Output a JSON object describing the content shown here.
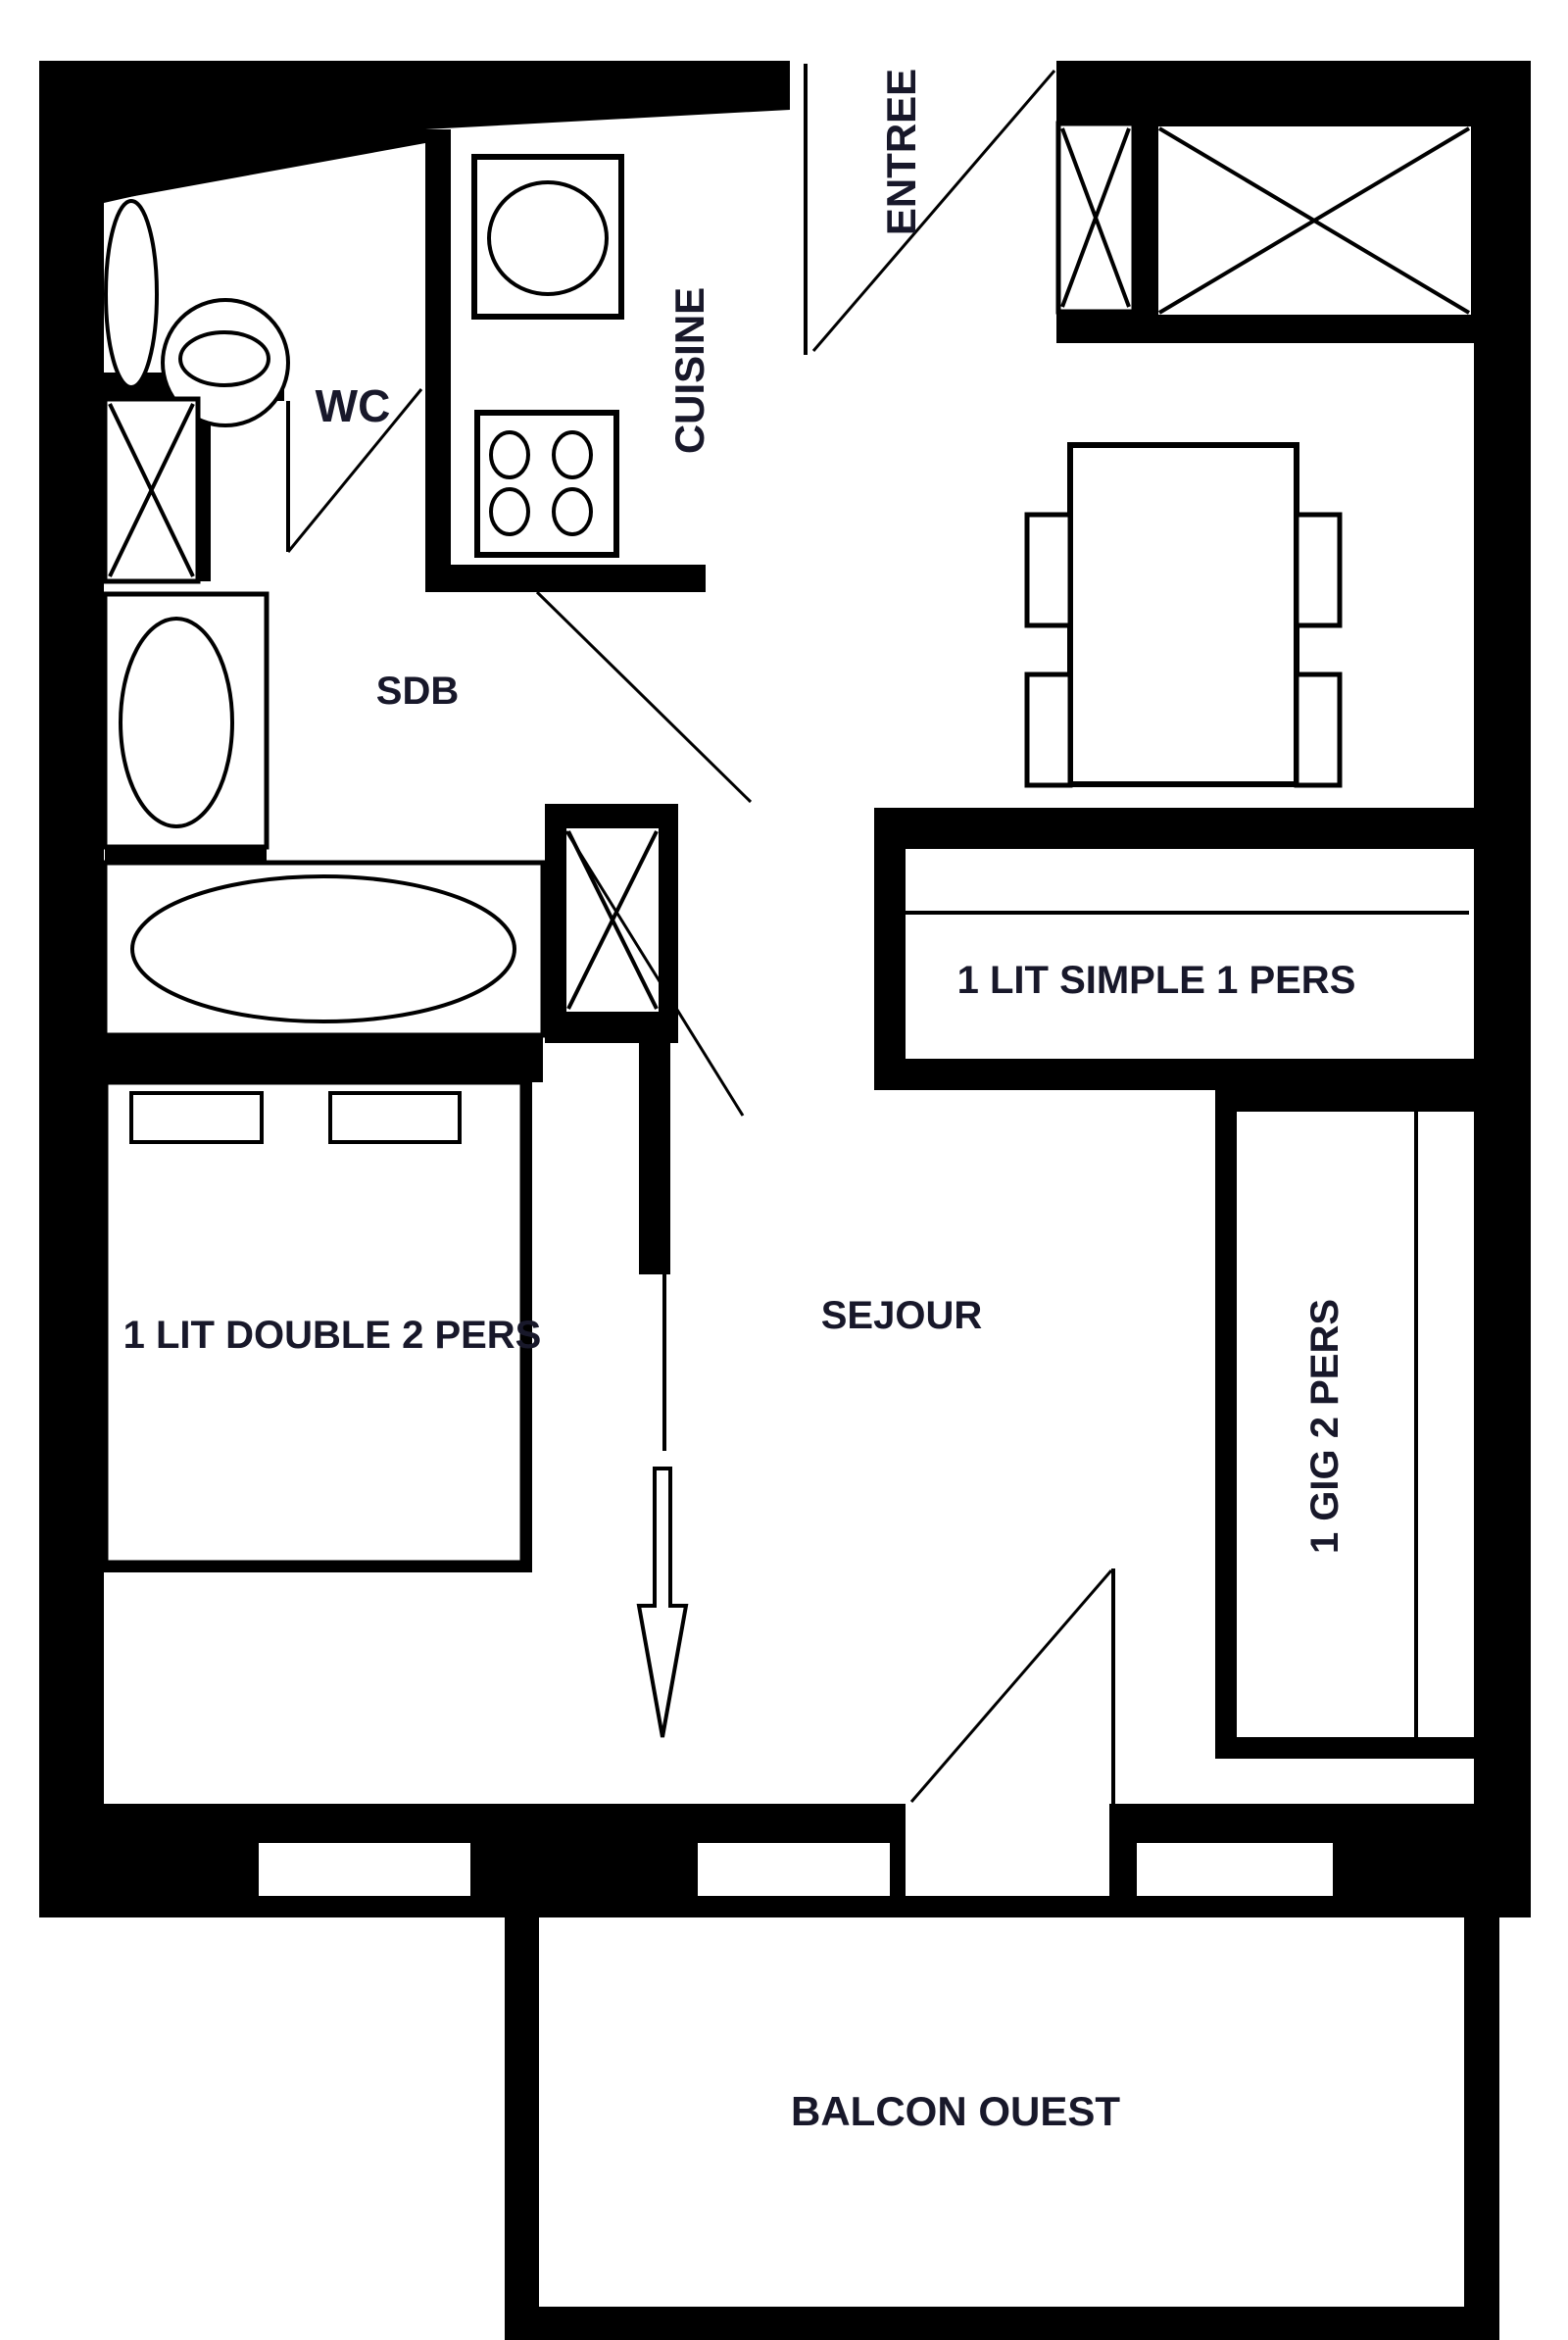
{
  "type": "floor-plan",
  "colors": {
    "wall": "#000000",
    "background": "#ffffff",
    "label": "#18182a"
  },
  "labels": {
    "wc": "WC",
    "cuisine": "CUISINE",
    "entree": "ENTREE",
    "sdb": "SDB",
    "sejour": "SEJOUR",
    "balcon": "BALCON OUEST",
    "lit_simple": "1 LIT SIMPLE 1 PERS",
    "lit_double": "1 LIT DOUBLE 2 PERS",
    "gig": "1 GIG 2 PERS"
  }
}
